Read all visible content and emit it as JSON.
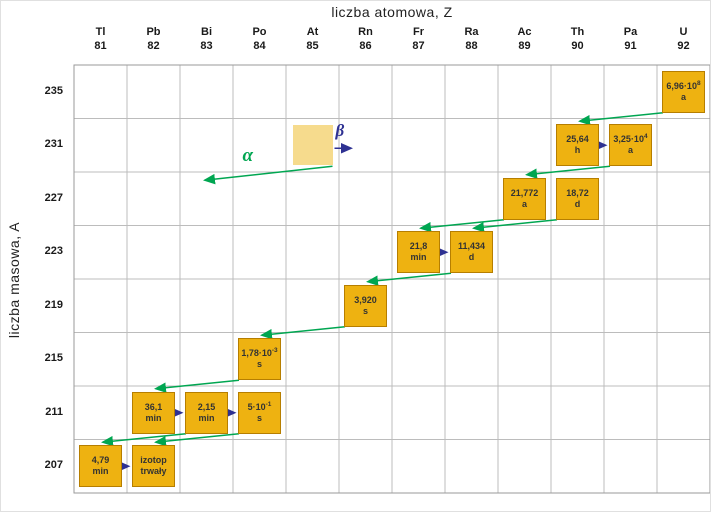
{
  "chart_data": {
    "type": "scatter",
    "title": "",
    "x_axis": {
      "label": "liczba atomowa, Z",
      "elements": [
        {
          "symbol": "Tl",
          "z": 81
        },
        {
          "symbol": "Pb",
          "z": 82
        },
        {
          "symbol": "Bi",
          "z": 83
        },
        {
          "symbol": "Po",
          "z": 84
        },
        {
          "symbol": "At",
          "z": 85
        },
        {
          "symbol": "Rn",
          "z": 86
        },
        {
          "symbol": "Fr",
          "z": 87
        },
        {
          "symbol": "Ra",
          "z": 88
        },
        {
          "symbol": "Ac",
          "z": 89
        },
        {
          "symbol": "Th",
          "z": 90
        },
        {
          "symbol": "Pa",
          "z": 91
        },
        {
          "symbol": "U",
          "z": 92
        }
      ]
    },
    "y_axis": {
      "label": "liczba masowa, A",
      "ticks": [
        235,
        231,
        227,
        223,
        219,
        215,
        211,
        207
      ]
    },
    "nuclides": [
      {
        "z": 92,
        "a": 235,
        "value": "6,96·10",
        "sup": "8",
        "unit": "a"
      },
      {
        "z": 90,
        "a": 231,
        "value": "25,64",
        "sup": "",
        "unit": "h"
      },
      {
        "z": 91,
        "a": 231,
        "value": "3,25·10",
        "sup": "4",
        "unit": "a"
      },
      {
        "z": 89,
        "a": 227,
        "value": "21,772",
        "sup": "",
        "unit": "a"
      },
      {
        "z": 90,
        "a": 227,
        "value": "18,72",
        "sup": "",
        "unit": "d"
      },
      {
        "z": 87,
        "a": 223,
        "value": "21,8",
        "sup": "",
        "unit": "min"
      },
      {
        "z": 88,
        "a": 223,
        "value": "11,434",
        "sup": "",
        "unit": "d"
      },
      {
        "z": 86,
        "a": 219,
        "value": "3,920",
        "sup": "",
        "unit": "s"
      },
      {
        "z": 84,
        "a": 215,
        "value": "1,78·10",
        "sup": "-3",
        "unit": "s"
      },
      {
        "z": 82,
        "a": 211,
        "value": "36,1",
        "sup": "",
        "unit": "min"
      },
      {
        "z": 83,
        "a": 211,
        "value": "2,15",
        "sup": "",
        "unit": "min"
      },
      {
        "z": 84,
        "a": 211,
        "value": "5·10",
        "sup": "-1",
        "unit": "s"
      },
      {
        "z": 81,
        "a": 207,
        "value": "4,79",
        "sup": "",
        "unit": "min"
      },
      {
        "z": 82,
        "a": 207,
        "value": "izotop",
        "sup": "",
        "unit": "trwały"
      }
    ],
    "alpha_decays": [
      [
        92,
        235,
        90,
        231
      ],
      [
        91,
        231,
        89,
        227
      ],
      [
        89,
        227,
        87,
        223
      ],
      [
        90,
        227,
        88,
        223
      ],
      [
        88,
        223,
        86,
        219
      ],
      [
        86,
        219,
        84,
        215
      ],
      [
        84,
        215,
        82,
        211
      ],
      [
        83,
        211,
        81,
        207
      ],
      [
        84,
        211,
        82,
        207
      ]
    ],
    "beta_decays": [
      [
        90,
        231,
        91,
        231
      ],
      [
        87,
        223,
        88,
        223
      ],
      [
        82,
        211,
        83,
        211
      ],
      [
        83,
        211,
        84,
        211
      ],
      [
        81,
        207,
        82,
        207
      ]
    ]
  },
  "legend": {
    "alpha_label": "α",
    "beta_label": "β",
    "swatch_z": 85,
    "swatch_a": 231
  },
  "colors": {
    "box_fill": "#eeb211",
    "box_border": "#b67e00",
    "box_text": "#333333",
    "alpha_arrow": "#00a651",
    "beta_arrow": "#2e3192",
    "grid_line": "#bcbcbc",
    "grid_border": "#9a9a9a",
    "legend_swatch": "#f6db8d",
    "axis_text": "#1a1a1a"
  }
}
